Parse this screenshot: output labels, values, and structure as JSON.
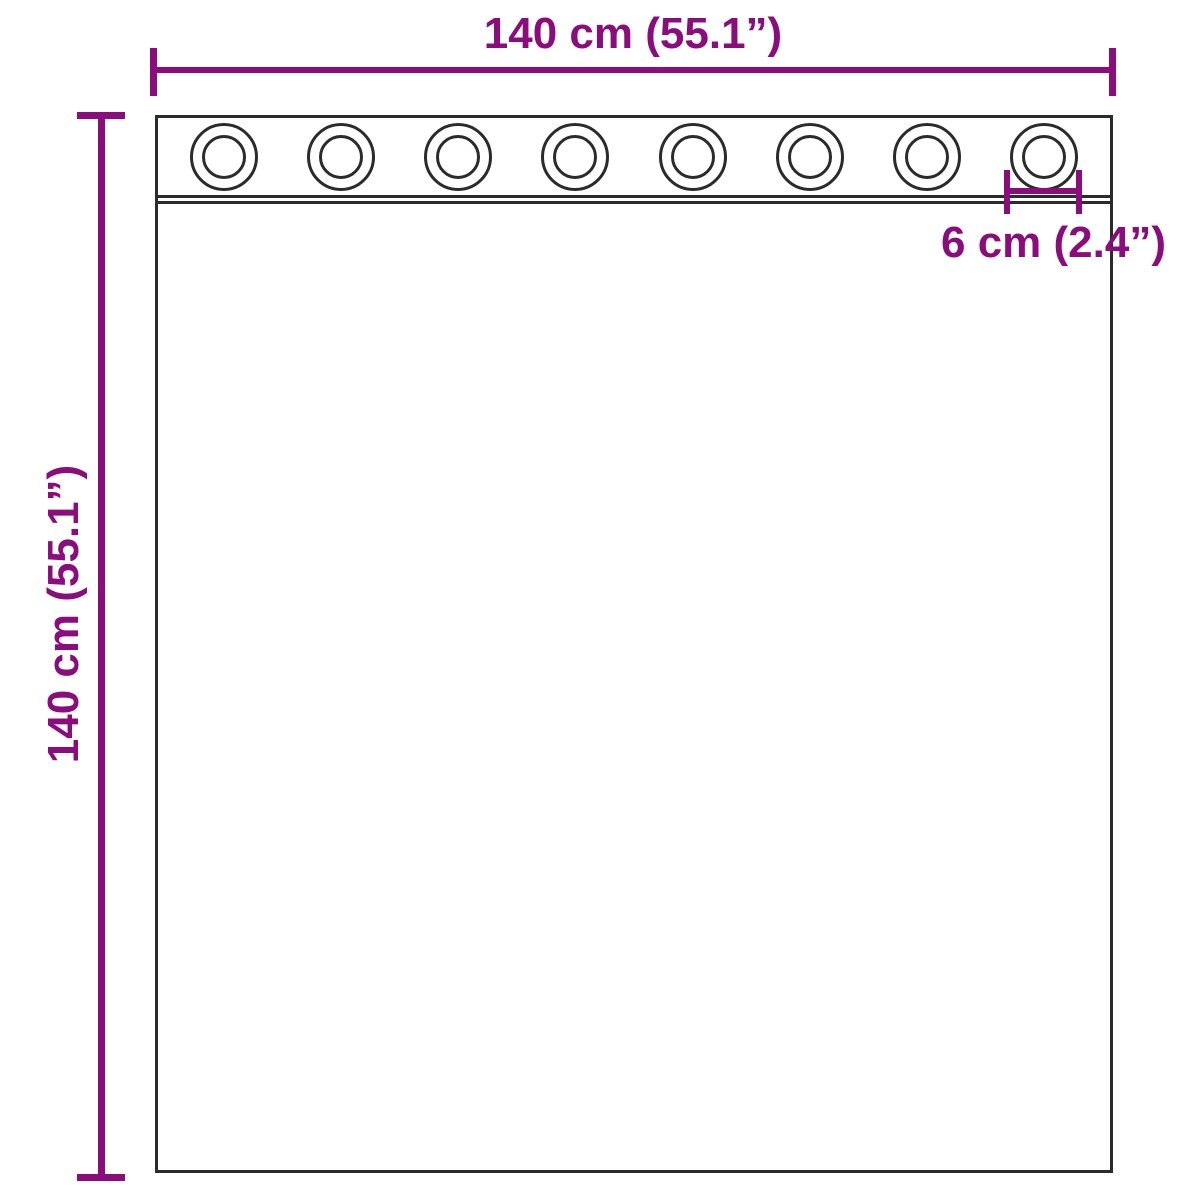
{
  "diagram": {
    "width_dimension": {
      "label": "140 cm (55.1”)"
    },
    "height_dimension": {
      "label": "140 cm (55.1”)"
    },
    "eyelet_spacing_dimension": {
      "label": "6 cm (2.4”)"
    },
    "eyelets": {
      "count": 8
    },
    "colors": {
      "dimension": "#8a0c7d",
      "outline": "#2b2b2b",
      "background": "#ffffff"
    }
  }
}
